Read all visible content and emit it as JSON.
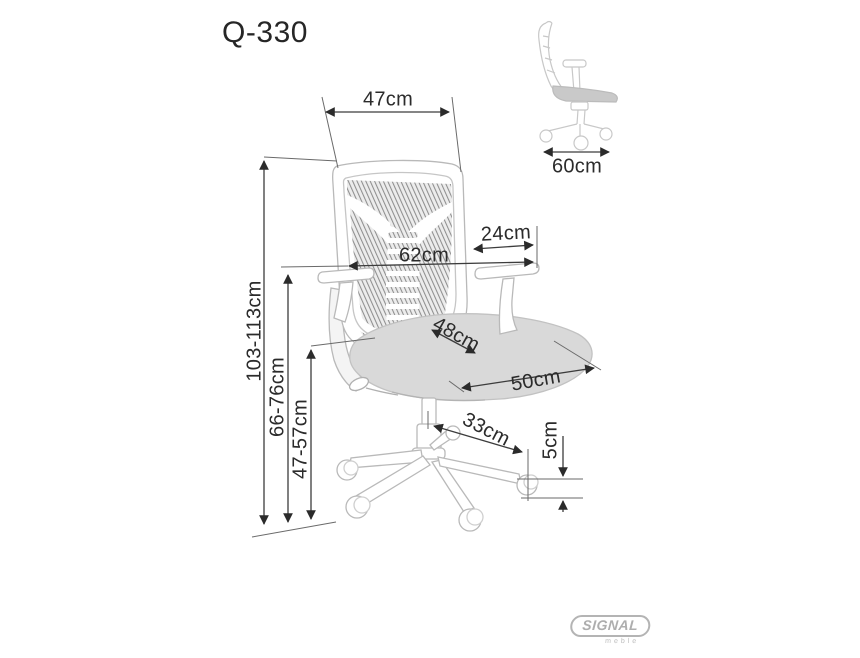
{
  "title": "Q-330",
  "dimensions": {
    "backrest_width": "47cm",
    "depth": "60cm",
    "armrest_length": "24cm",
    "overall_width": "62cm",
    "seat_depth": "48cm",
    "seat_width": "50cm",
    "base_leg_length": "33cm",
    "caster_height": "5cm",
    "total_height": "103-113cm",
    "armrest_height": "66-76cm",
    "seat_height": "47-57cm"
  },
  "logo": {
    "brand": "SIGNAL",
    "sub": "meble"
  },
  "colors": {
    "background": "#ffffff",
    "ink": "#2b2b2b",
    "dimension_line": "#565656",
    "chair_outline": "#b9b9b9",
    "seat_fill": "#d9d9d9",
    "mesh_hatch": "#8f8f8f",
    "logo_gray": "#b0b0b0"
  }
}
